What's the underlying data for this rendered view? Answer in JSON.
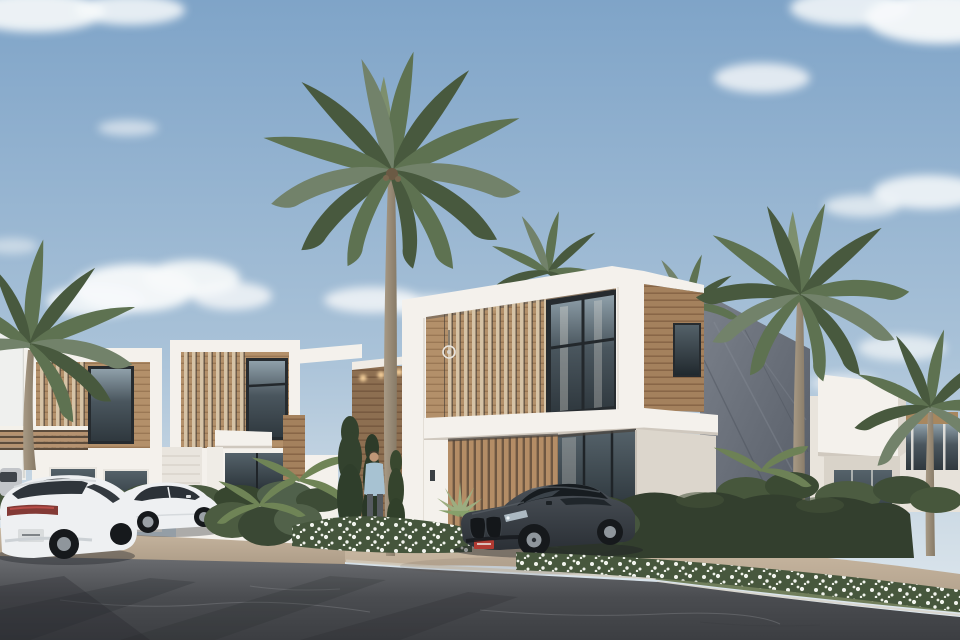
{
  "scene": {
    "title": "Modern villa community exterior rendering",
    "time_of_day": "day",
    "description": "Corner street view of modern two-story white villas with wooden slat facades, coconut palms, flowering hedges, parked cars and a man standing by the entrance landscaping"
  },
  "objects": {
    "villas": [
      "left villa",
      "middle villa",
      "main corner villa with slate side wall",
      "right villa",
      "distant houses"
    ],
    "vehicles": [
      "white suv coupe (rear view)",
      "white sedan",
      "dark gray sports coupe",
      "distant parked car"
    ],
    "people": [
      "man in light blue shirt and gray pants"
    ],
    "vegetation": [
      "coconut palms",
      "columnar cypress shrubs",
      "clipped dark hedge",
      "white flower beds",
      "agave plant"
    ],
    "license_plate_color": "red"
  },
  "colors": {
    "sky_top": "#7fa4c8",
    "sky_mid": "#a9c2d8",
    "sky_low": "#cfdce6",
    "sky_horizon": "#e3ebf0",
    "cloud": "#f7f9fa",
    "wall_white": "#f4f1ec",
    "wall_shade": "#e6e1d9",
    "wall_dark": "#d9d3c9",
    "wood_light": "#b3906a",
    "wood_dark": "#a4815d",
    "wood_line": "#8d6c4a",
    "slat_light": "#d6c3a6",
    "slat_base": "#6e5742",
    "slat_mid": "#b48d66",
    "frame_dark": "#262b2f",
    "glass_top": "#8fa0aa",
    "glass_mid": "#4a565e",
    "glass_low": "#2f383e",
    "stone_light": "#7b818b",
    "stone_dark": "#555b65",
    "hedge": "#333f2e",
    "bush_dark": "#3a4834",
    "bush_mid": "#4c5c41",
    "bush_light": "#52624a",
    "palm_green": "#5e7251",
    "palm_dark": "#48593e",
    "palm_gray": "#72826a",
    "trunk_light": "#a89a85",
    "trunk_dark": "#877a67",
    "grass_strip": "#68764f",
    "flower": "#f2f4ee",
    "bed_green": "#4c5c42",
    "pavement_light": "#c8b7a1",
    "pavement_dark": "#ad9c87",
    "curb": "#d8d2c5",
    "asphalt_light": "#6b6d71",
    "asphalt_mid": "#4a4c50",
    "asphalt_dark": "#3c3e42",
    "shadow": "#23262a",
    "car_white": "#eef0f2",
    "car_glass": "#2f353b",
    "taillight": "#833a36",
    "bmw_top": "#4b5158",
    "bmw_low": "#2b3036",
    "tire": "#16191c",
    "rim": "#8f969c",
    "plate_red": "#b03a32",
    "skin": "#c09677",
    "shirt": "#a7c2d2",
    "pants": "#565b60",
    "glow": "#ffd9a2"
  }
}
